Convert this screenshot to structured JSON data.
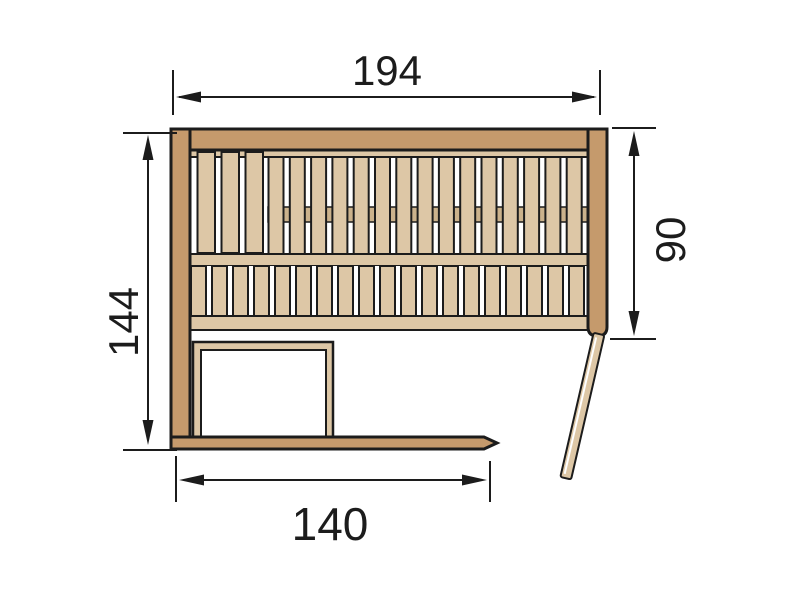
{
  "diagram": {
    "type": "floor-plan",
    "subject": "sauna-top-view",
    "dimensions": {
      "top": {
        "label": "194"
      },
      "left": {
        "label": "144"
      },
      "right": {
        "label": "90"
      },
      "bottom": {
        "label": "140"
      }
    },
    "colors": {
      "wall": "#c59a6c",
      "wood": "#ddc7a6",
      "wood_dark": "#cbb28c",
      "outline": "#1c1c1c",
      "background": "#ffffff"
    },
    "benches": {
      "upper_wide_slat_count": 3,
      "upper_slat_count": 15,
      "lower_slat_count": 19
    }
  }
}
